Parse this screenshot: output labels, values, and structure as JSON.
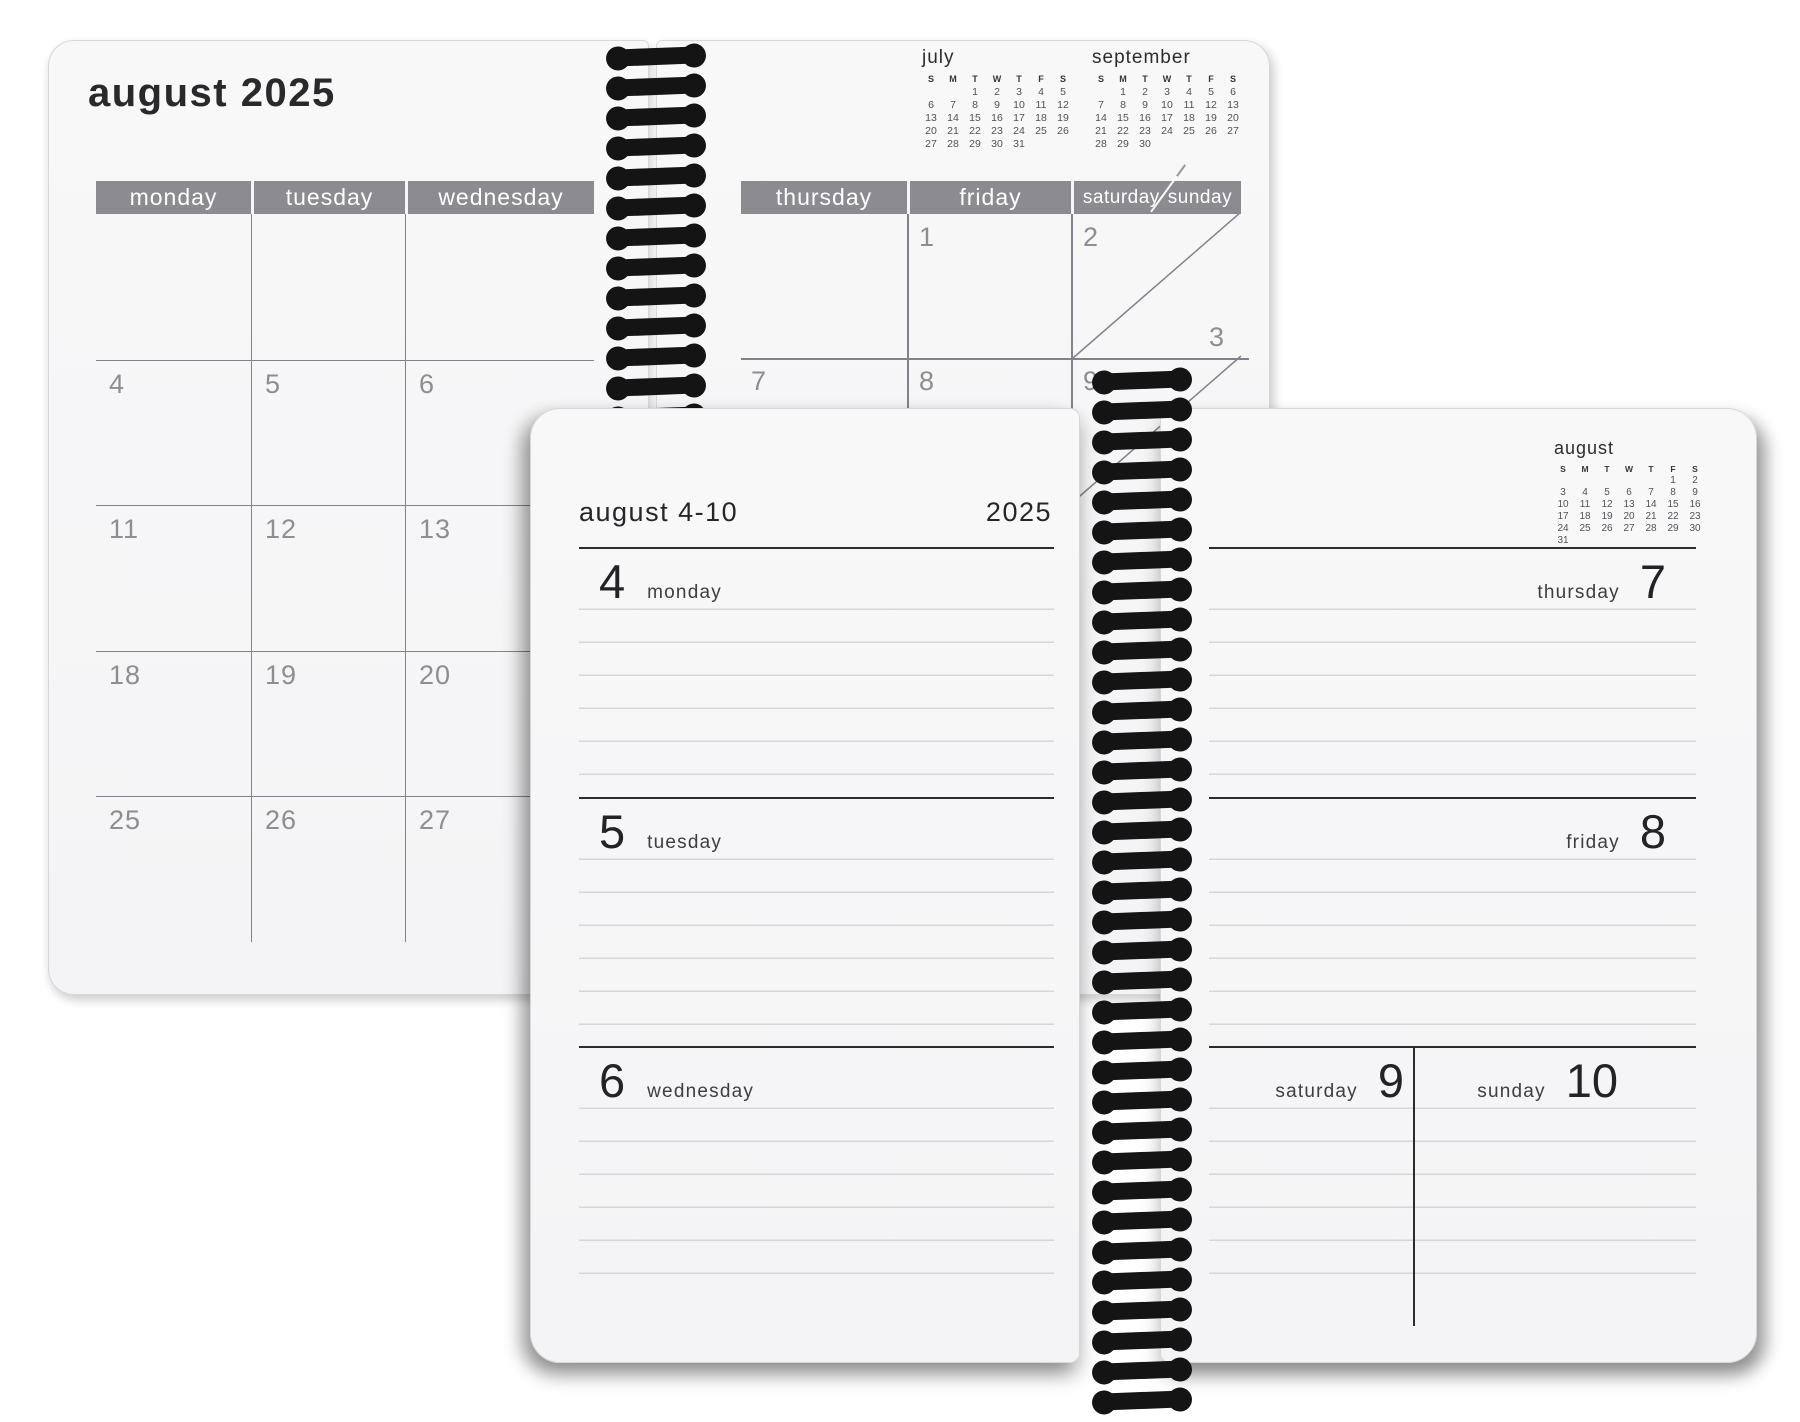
{
  "monthly": {
    "title": "august 2025",
    "left_day_headers": [
      "monday",
      "tuesday",
      "wednesday"
    ],
    "right_day_headers": [
      "thursday",
      "friday"
    ],
    "weekend_header": {
      "saturday": "saturday",
      "sunday": "sunday"
    },
    "left_weeks": [
      [
        "",
        "",
        ""
      ],
      [
        "4",
        "5",
        "6"
      ],
      [
        "11",
        "12",
        "13"
      ],
      [
        "18",
        "19",
        "20"
      ],
      [
        "25",
        "26",
        "27"
      ]
    ],
    "right_cells": {
      "friday_week1": "1",
      "saturday_week1": "2",
      "sunday_week1": "3",
      "thursday_week2": "7",
      "friday_week2": "8",
      "saturday_week2": "9"
    }
  },
  "mini_calendars": {
    "day_letters": [
      "S",
      "M",
      "T",
      "W",
      "T",
      "F",
      "S"
    ],
    "july": {
      "title": "july",
      "weeks": [
        [
          "",
          "",
          "1",
          "2",
          "3",
          "4",
          "5"
        ],
        [
          "6",
          "7",
          "8",
          "9",
          "10",
          "11",
          "12"
        ],
        [
          "13",
          "14",
          "15",
          "16",
          "17",
          "18",
          "19"
        ],
        [
          "20",
          "21",
          "22",
          "23",
          "24",
          "25",
          "26"
        ],
        [
          "27",
          "28",
          "29",
          "30",
          "31",
          "",
          ""
        ]
      ]
    },
    "september": {
      "title": "september",
      "weeks": [
        [
          "",
          "1",
          "2",
          "3",
          "4",
          "5",
          "6"
        ],
        [
          "7",
          "8",
          "9",
          "10",
          "11",
          "12",
          "13"
        ],
        [
          "14",
          "15",
          "16",
          "17",
          "18",
          "19",
          "20"
        ],
        [
          "21",
          "22",
          "23",
          "24",
          "25",
          "26",
          "27"
        ],
        [
          "28",
          "29",
          "30",
          "",
          "",
          "",
          ""
        ]
      ]
    },
    "august": {
      "title": "august",
      "weeks": [
        [
          "",
          "",
          "",
          "",
          "",
          "1",
          "2"
        ],
        [
          "3",
          "4",
          "5",
          "6",
          "7",
          "8",
          "9"
        ],
        [
          "10",
          "11",
          "12",
          "13",
          "14",
          "15",
          "16"
        ],
        [
          "17",
          "18",
          "19",
          "20",
          "21",
          "22",
          "23"
        ],
        [
          "24",
          "25",
          "26",
          "27",
          "28",
          "29",
          "30"
        ],
        [
          "31",
          "",
          "",
          "",
          "",
          "",
          ""
        ]
      ]
    }
  },
  "weekly": {
    "title": "august 4-10",
    "year": "2025",
    "left_days": [
      {
        "num": "4",
        "label": "monday"
      },
      {
        "num": "5",
        "label": "tuesday"
      },
      {
        "num": "6",
        "label": "wednesday"
      }
    ],
    "right_days": [
      {
        "num": "7",
        "label": "thursday"
      },
      {
        "num": "8",
        "label": "friday"
      }
    ],
    "weekend_days": [
      {
        "num": "9",
        "label": "saturday"
      },
      {
        "num": "10",
        "label": "sunday"
      }
    ]
  },
  "colors": {
    "header_band": "#8c8c90",
    "ink": "#2b2b2e",
    "muted_number": "#8d8d92",
    "ruled_line": "#d6d6da"
  }
}
